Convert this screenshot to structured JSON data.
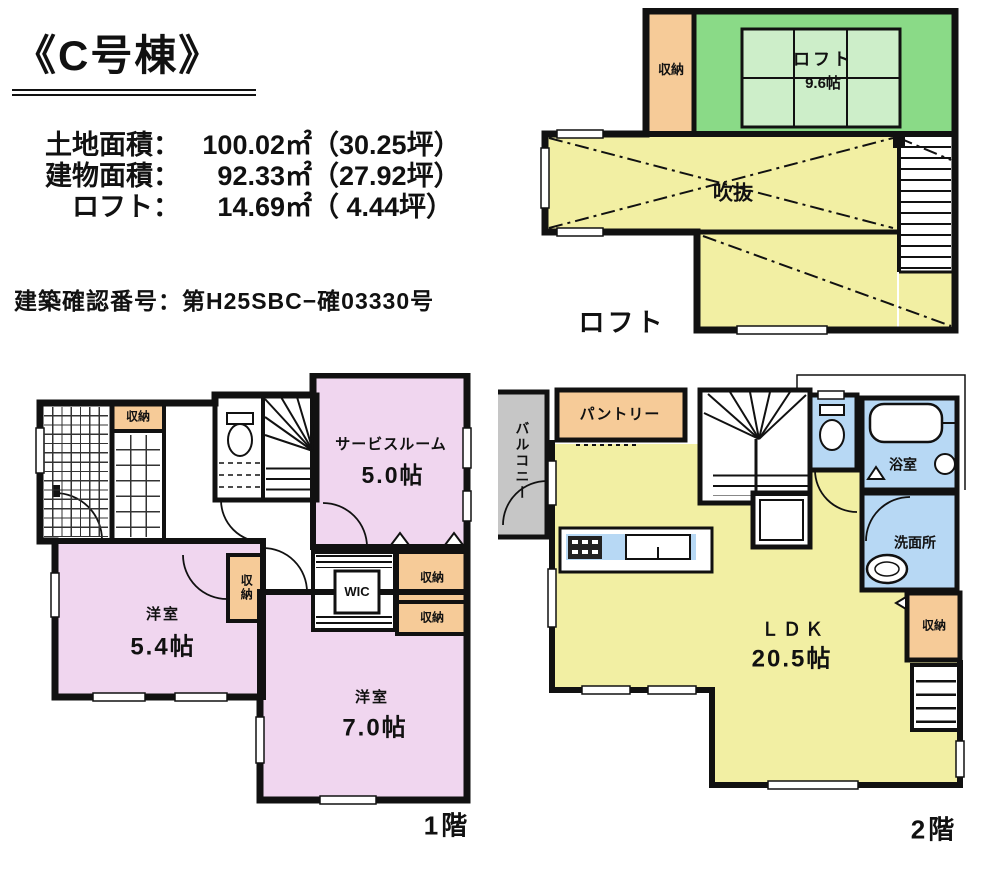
{
  "page": {
    "title": "《C号棟》",
    "confirmation": "建築確認番号：第H25SBC−確03330号"
  },
  "areas": [
    {
      "label": "土地面積：",
      "value": "100.02㎡",
      "tsubo": "（30.25坪）"
    },
    {
      "label": "建物面積：",
      "value": "92.33㎡",
      "tsubo": "（27.92坪）"
    },
    {
      "label": "ロフト：",
      "value": "14.69㎡",
      "tsubo": "（ 4.44坪）"
    }
  ],
  "loft": {
    "caption": "ロフト",
    "closet": "収納",
    "name": "ロフト",
    "size": "9.6帖",
    "void_label": "吹抜"
  },
  "f1": {
    "caption": "1階",
    "entry_closet": "収納",
    "service_name": "サービスルーム",
    "service_size": "5.0帖",
    "west_name": "洋室",
    "west_size": "5.4帖",
    "center_closet": "収納",
    "wic": "WIC",
    "closet_a": "収納",
    "closet_b": "収納",
    "south_name": "洋室",
    "south_size": "7.0帖"
  },
  "f2": {
    "caption": "2階",
    "balcony": "バルコニー",
    "pantry": "パントリー",
    "bath": "浴室",
    "wash": "洗面所",
    "closet": "収納",
    "ldk_name": "ＬＤＫ",
    "ldk_size": "20.5帖"
  },
  "colors": {
    "wall": "#111111",
    "loft_green": "#8ada87",
    "loft_mat_green": "#cdeec9",
    "void_yellow": "#f2efa3",
    "room_pink": "#f0d6ef",
    "closet_orange": "#f6cb98",
    "wet_blue": "#b7d8f4",
    "balcony_gray": "#c6c6c6"
  }
}
